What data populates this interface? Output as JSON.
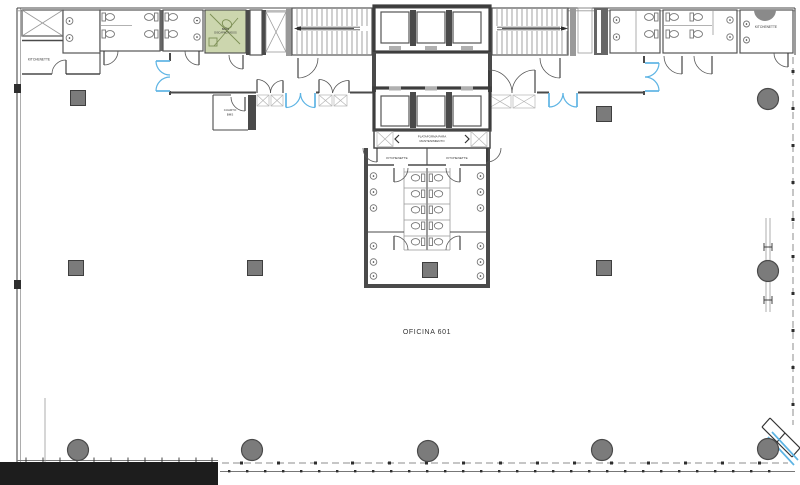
{
  "plan": {
    "labels": {
      "kitchenette_top_left": "KITCHENETTE",
      "kitchenette_top_right": "KITCHENETTE",
      "kitchenette_core_left": "KITCHENETTE",
      "kitchenette_core_right": "KITCHENETTE",
      "accessible_wc_line1": "BAÑO",
      "accessible_wc_line2": "DISCAPACITADOS",
      "bms_room_line1": "CUARTO",
      "bms_room_line2": "BMS",
      "platform_line1": "PLATAFORMA PARA",
      "platform_line2": "MANTENIMIENTO",
      "office_name": "OFICINA 601"
    },
    "colors": {
      "wall_dark": "#4a4a4a",
      "door_accent_blue": "#5db4e4",
      "accessible_room_green": "#ccd6ae",
      "column_gray": "#7b7b7b",
      "boundary_dash_gray": "#8c8c8c",
      "solid_band_black": "#1d1d1d"
    },
    "columns": {
      "square": [
        [
          78,
          98
        ],
        [
          604,
          114
        ],
        [
          76,
          268
        ],
        [
          255,
          268
        ],
        [
          430,
          270
        ],
        [
          604,
          268
        ]
      ],
      "round": [
        [
          768,
          99
        ],
        [
          768,
          271
        ],
        [
          78,
          450
        ],
        [
          252,
          450
        ],
        [
          428,
          451
        ],
        [
          602,
          450
        ],
        [
          768,
          449
        ]
      ]
    }
  }
}
